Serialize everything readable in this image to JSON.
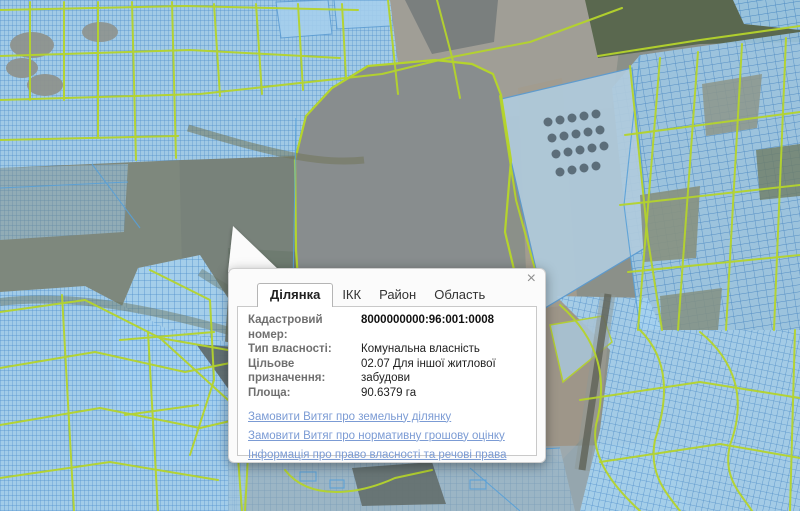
{
  "popup": {
    "close_icon": "×",
    "tabs": [
      {
        "label": "Ділянка",
        "active": true
      },
      {
        "label": "ІКК",
        "active": false
      },
      {
        "label": "Район",
        "active": false
      },
      {
        "label": "Область",
        "active": false
      }
    ],
    "fields": [
      {
        "label": "Кадастровий номер:",
        "value": "8000000000:96:001:0008"
      },
      {
        "label": "Тип власності:",
        "value": "Комунальна власність"
      },
      {
        "label": "Цільове призначення:",
        "value": "02.07 Для іншої житлової забудови"
      },
      {
        "label": "Площа:",
        "value": "90.6379 га"
      }
    ],
    "links": [
      {
        "label": "Замовити Витяг про земельну ділянку"
      },
      {
        "label": "Замовити Витяг про нормативну грошову оцінку"
      },
      {
        "label": "Інформація про право власності та речові права"
      }
    ]
  },
  "map": {
    "colors": {
      "zone_boundary_green": "#b5d42c",
      "parcel_outline_blue": "#5a9bd2",
      "parcel_fill_blue": "#a5cfee",
      "terrain_gray_green": "#8b9089",
      "link_blue": "#7b9bd4"
    }
  }
}
